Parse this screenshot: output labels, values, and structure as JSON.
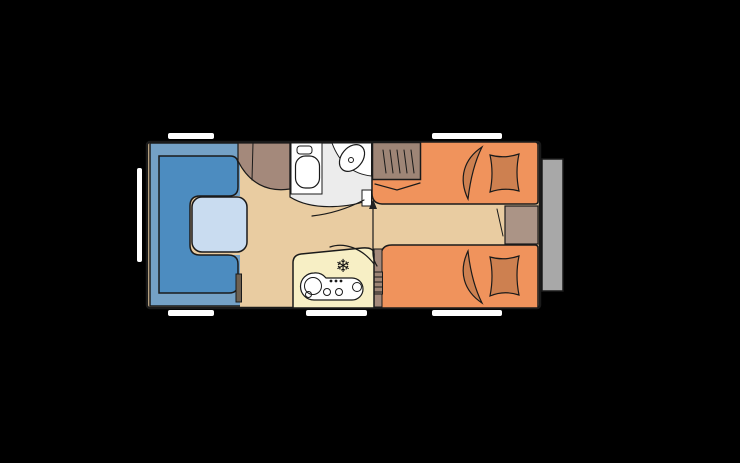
{
  "scene": {
    "kind": "caravan-floor-plan",
    "background": "#000000"
  },
  "icons": {
    "fridge_snowflake": "❄"
  },
  "colors": {
    "floor": "#e9cca1",
    "wallStroke": "#1a1a1a",
    "window": "#ffffff",
    "dinetteOuter": "#74a1c6",
    "dinetteSeat": "#4c8cc0",
    "table": "#c9dcf0",
    "bed": "#f0935c",
    "bedding": "#cd8050",
    "cabinet": "#a4897b",
    "wardrobe": "#9e8576",
    "bedsideChest": "#ab9486",
    "darkChest": "#6e6152",
    "washroomFloor": "#ececec",
    "fixtureWhite": "#ffffff",
    "kitchen": "#f7efc5",
    "entryDoor": "#a8a8a8",
    "arrow": "#222222"
  },
  "legend": {
    "left": "u-shaped-dinette-with-table",
    "middle_top": "washroom-toilet-and-basin",
    "middle_bottom": "kitchen-with-cooktop-sink-and-fridge",
    "right": "two-single-beds-with-wardrobe",
    "right_outside": "entry-door"
  }
}
